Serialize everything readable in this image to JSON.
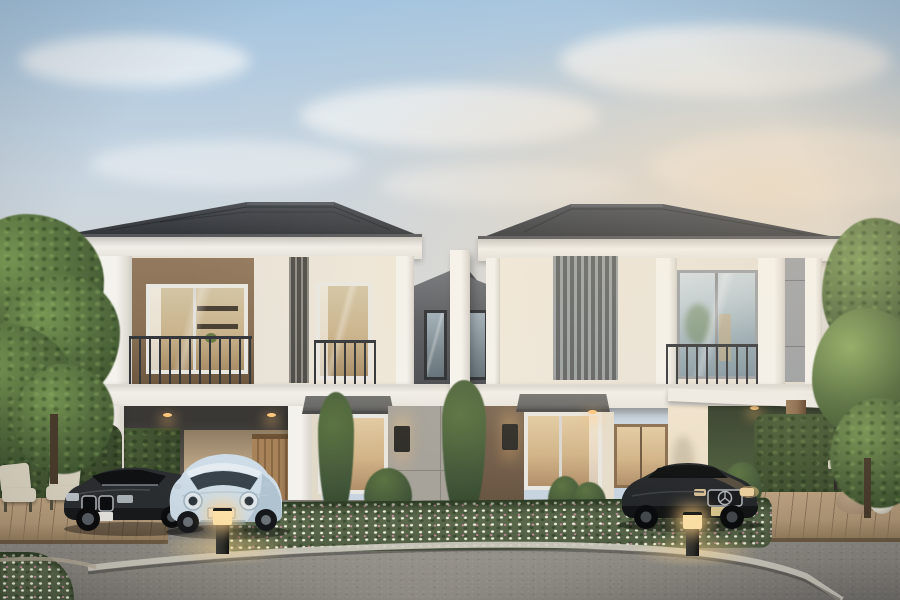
{
  "scene": {
    "description": "Photorealistic dusk exterior render of a twin two-storey duplex (two mirrored houses joined by a recessed dark centre bay) with hip tile roofs, balconies, vertical louvre screens, open carports, landscaped flower bed, and three parked cars",
    "house_count": 2,
    "car_count": 3,
    "cars": [
      {
        "name": "dark-sedan",
        "position": "left carport",
        "body_color": "#2b2e31"
      },
      {
        "name": "pale-blue-hatchback",
        "position": "left driveway",
        "body_color": "#cddce7"
      },
      {
        "name": "black-sedan",
        "position": "right carport",
        "body_color": "#24272a"
      }
    ],
    "lighting": {
      "bollard_lamps": 2,
      "wall_sconces": 2,
      "ceiling_downlights": 4,
      "sconces_lit": true
    }
  },
  "colors": {
    "sky_top": "#a4c4df",
    "sky_mid": "#c8d5e0",
    "sky_low": "#ddd9d3",
    "sky_warm": "#e8d4ba",
    "cloud": "#f0f3f5",
    "roof": "#36393e",
    "roof_ridge": "#5a5e64",
    "fascia": "#f1efe9",
    "gutter": "#55575a",
    "wall_cream": "#eae4d8",
    "wall_cream_warm": "#efe8da",
    "col_white": "#f4f2ec",
    "panel_brown": "#8a7156",
    "louver_a": "#8f8d86",
    "louver_b": "#504e49",
    "louver2_a": "#9aa0a0",
    "louver2_b": "#5e6263",
    "center_wall": "#54575c",
    "center_wall_top": "#6e7278",
    "pillar": "#f6f4ee",
    "band": "#f2efe9",
    "glass_hi": "#d3dde2",
    "glass_lo": "#7e939e",
    "glass_frame": "#e9e7e1",
    "frame_gray": "#9b9fa3",
    "win_dark_frame": "#2a2d31",
    "room_warm": "#c9b38c",
    "room_shelf": "#4a4034",
    "rail": "#33363a",
    "gpanel": "#a7a39b",
    "seam": "#8b877f",
    "brown_wall": "#6e5a47",
    "lit_wall": "#ecdfc8",
    "carport_dark": "#3a3835",
    "backwall": "#c3ab8a",
    "door": "#a8835a",
    "awning": "#6a6a68",
    "sconce": "#312f2a",
    "downlight": "#ffc87c",
    "hedge": "#4c6038",
    "hedge_dark": "#3a4a2c",
    "tree": "#577040",
    "tree_light": "#7a9a55",
    "tree_dark": "#3e5430",
    "trunk": "#4a3c2c",
    "bed_green": "#5a684b",
    "flower_white": "#ecefdb",
    "flower_pink": "#c98ca0",
    "deck": "#b49a7a",
    "deck_line": "#8f775c",
    "chair": "#ddd6c4",
    "chair_dark": "#55503f",
    "beanbag": "#ab9276",
    "sphere": "#e2ddd0",
    "drive": "#8e8c86",
    "drive_dark": "#74726e",
    "curb": "#cfccc1",
    "concrete": "#817c72",
    "bollard": "#2a2a27",
    "bollard_glow": "#ffe3a8",
    "bmw": "#2b2e31",
    "bmw_dark": "#17191b",
    "chrome": "#b3b9be",
    "ora": "#cddce7",
    "ora_dark": "#9db2c1",
    "ora_roof": "#e4ecf2",
    "ora_glass": "#39434b",
    "merc": "#24272a",
    "merc_dark": "#121415",
    "merc_warm": "#8a7354",
    "plate": "#eceae4",
    "plate_y": "#d9c78e",
    "post": "#8a6a4c"
  }
}
